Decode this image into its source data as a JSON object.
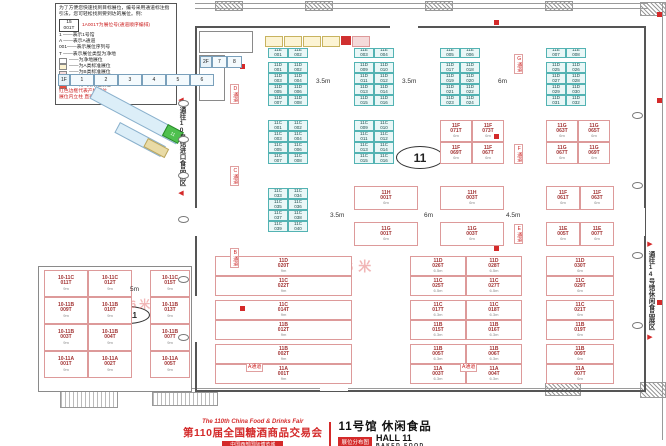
{
  "legend": {
    "intro": "为了方便您快速找到目标展位，编号采用通道标注指引法，您可轻松找到要到达的展位。例：",
    "example_no": "15",
    "example_code": "001T",
    "example_note": "1A001T为展位号(通道顺序编排)",
    "defs": [
      "1 ——表示1号馆",
      "A ——表示A通道",
      "001——表示展位序列号",
      "T ——表示展位类型为净地"
    ],
    "swatches": [
      {
        "color": "#ffffff",
        "label": "——为净地展位"
      },
      {
        "color": "#fdf3d1",
        "label": "——为A类标准展位"
      },
      {
        "color": "#f9dcdc",
        "label": "——为B类标准展位"
      },
      {
        "color": "#e0f3f3",
        "label": "——为C类标准展位"
      },
      {
        "color": "#e74c3c",
        "label": "——为D类标准展位"
      }
    ],
    "notes": [
      "红色边框代表产权展位",
      "展位内立柱 直径均为1.5m"
    ]
  },
  "minimap": {
    "floors": [
      {
        "label": "2F",
        "x": 200,
        "y": 56,
        "cw": 13,
        "cells": [
          "7",
          "8"
        ]
      },
      {
        "label": "1F",
        "x": 58,
        "y": 74,
        "cw": 22,
        "cells": [
          "1",
          "2",
          "3",
          "4",
          "5",
          "6"
        ]
      }
    ],
    "current": "11"
  },
  "corridors": {
    "left": "通往10号馆进口食品展区",
    "right": "通往14号馆休闲食品展区",
    "left_arrow": "◀",
    "right_arrow": "▶"
  },
  "ovals": {
    "hall": "11",
    "wing": "10-11"
  },
  "watermark": {
    "text": "净地展位限高6米"
  },
  "title": {
    "en": "The 110th China Food & Drinks Fair",
    "cn": "第110届全国糖酒商品交易会",
    "sub": "中国西部国际博览城",
    "hall_cn": "11号馆 休闲食品",
    "hall_en": "HALL 11",
    "hall_sub": "BAKED FOOD",
    "badge": "展位分布图"
  },
  "dim_labels": [
    {
      "t": "3.5m",
      "x": 316,
      "y": 78
    },
    {
      "t": "3.5m",
      "x": 402,
      "y": 78
    },
    {
      "t": "6m",
      "x": 498,
      "y": 78
    },
    {
      "t": "3.5m",
      "x": 330,
      "y": 212
    },
    {
      "t": "6m",
      "x": 424,
      "y": 212
    },
    {
      "t": "4.5m",
      "x": 506,
      "y": 212
    },
    {
      "t": "5m",
      "x": 130,
      "y": 286
    }
  ],
  "aisle_labels": [
    {
      "t": "D通道",
      "x": 230,
      "y": 84,
      "v": 1
    },
    {
      "t": "C通道",
      "x": 230,
      "y": 166,
      "v": 1
    },
    {
      "t": "B通道",
      "x": 230,
      "y": 248,
      "v": 1
    },
    {
      "t": "G通道",
      "x": 514,
      "y": 54,
      "v": 1
    },
    {
      "t": "F通道",
      "x": 514,
      "y": 144,
      "v": 1
    },
    {
      "t": "E通道",
      "x": 514,
      "y": 224,
      "v": 1
    },
    {
      "t": "A通道",
      "x": 246,
      "y": 363,
      "v": 0
    },
    {
      "t": "A通道",
      "x": 460,
      "y": 363,
      "v": 0
    }
  ],
  "fire_icons": [
    [
      494,
      20
    ],
    [
      494,
      134
    ],
    [
      494,
      246
    ],
    [
      657,
      12
    ],
    [
      657,
      98
    ],
    [
      657,
      300
    ],
    [
      240,
      64
    ],
    [
      240,
      306
    ]
  ],
  "column_markers": [
    [
      178,
      100
    ],
    [
      178,
      136
    ],
    [
      178,
      172
    ],
    [
      178,
      216
    ],
    [
      178,
      276
    ],
    [
      178,
      334
    ],
    [
      632,
      112
    ],
    [
      632,
      182
    ],
    [
      632,
      252
    ],
    [
      632,
      322
    ]
  ],
  "booths": [
    {
      "x": 268,
      "y": 48,
      "cols": 2,
      "cw": 20,
      "ch": 10,
      "type": "std",
      "labels": [
        "11E 001",
        "11E 002"
      ]
    },
    {
      "x": 354,
      "y": 48,
      "cols": 2,
      "cw": 20,
      "ch": 10,
      "type": "std",
      "labels": [
        "11E 003",
        "11E 004"
      ]
    },
    {
      "x": 440,
      "y": 48,
      "cols": 2,
      "cw": 20,
      "ch": 10,
      "type": "std",
      "labels": [
        "11E 005",
        "11E 006"
      ]
    },
    {
      "x": 546,
      "y": 48,
      "cols": 2,
      "cw": 20,
      "ch": 10,
      "type": "std",
      "labels": [
        "11E 007",
        "11E 008"
      ]
    },
    {
      "x": 268,
      "y": 62,
      "cols": 2,
      "cw": 20,
      "ch": 11,
      "type": "std",
      "labels": [
        "11D 001",
        "11D 002",
        "11D 003",
        "11D 004",
        "11D 005",
        "11D 006",
        "11D 007",
        "11D 008"
      ]
    },
    {
      "x": 354,
      "y": 62,
      "cols": 2,
      "cw": 20,
      "ch": 11,
      "type": "std",
      "labels": [
        "11D 009",
        "11D 010",
        "11D 011",
        "11D 012",
        "11D 013",
        "11D 014",
        "11D 015",
        "11D 016"
      ]
    },
    {
      "x": 440,
      "y": 62,
      "cols": 2,
      "cw": 20,
      "ch": 11,
      "type": "std",
      "labels": [
        "11D 017",
        "11D 018",
        "11D 019",
        "11D 020",
        "11D 021",
        "11D 022",
        "11D 023",
        "11D 024"
      ]
    },
    {
      "x": 546,
      "y": 62,
      "cols": 2,
      "cw": 20,
      "ch": 11,
      "type": "std",
      "labels": [
        "11D 025",
        "11D 026",
        "11D 027",
        "11D 028",
        "11D 029",
        "11D 030",
        "11D 031",
        "11D 032"
      ]
    },
    {
      "x": 268,
      "y": 120,
      "cols": 2,
      "cw": 20,
      "ch": 11,
      "type": "std",
      "labels": [
        "11C 001",
        "11C 002",
        "11C 003",
        "11C 004",
        "11C 005",
        "11C 006",
        "11C 007",
        "11C 008"
      ]
    },
    {
      "x": 354,
      "y": 120,
      "cols": 2,
      "cw": 20,
      "ch": 11,
      "type": "std",
      "labels": [
        "11C 009",
        "11C 010",
        "11C 011",
        "11C 012",
        "11C 013",
        "11C 014",
        "11C 015",
        "11C 016"
      ]
    },
    {
      "x": 440,
      "y": 120,
      "cols": 2,
      "cw": 32,
      "ch": 22,
      "type": "special",
      "dim": "6m",
      "labels": [
        "11F 071T",
        "11F 073T",
        "11F 069T",
        "11F 067T"
      ]
    },
    {
      "x": 546,
      "y": 120,
      "cols": 2,
      "cw": 32,
      "ch": 22,
      "type": "special",
      "dim": "6m",
      "labels": [
        "11G 063T",
        "11G 065T",
        "11G 067T",
        "11G 069T"
      ]
    },
    {
      "x": 268,
      "y": 188,
      "cols": 2,
      "cw": 20,
      "ch": 11,
      "type": "std",
      "labels": [
        "11C 033",
        "11C 034",
        "11C 035",
        "11C 036",
        "11C 037",
        "11C 038",
        "11C 039",
        "11C 040"
      ]
    },
    {
      "x": 354,
      "y": 186,
      "cols": 1,
      "cw": 64,
      "ch": 24,
      "type": "special",
      "dim": "6m",
      "labels": [
        "11H 001T"
      ]
    },
    {
      "x": 440,
      "y": 186,
      "cols": 1,
      "cw": 64,
      "ch": 24,
      "type": "special",
      "dim": "6m",
      "labels": [
        "11H 003T"
      ]
    },
    {
      "x": 546,
      "y": 186,
      "cols": 2,
      "cw": 34,
      "ch": 24,
      "type": "special",
      "dim": "6m",
      "labels": [
        "11F 061T",
        "11F 063T"
      ]
    },
    {
      "x": 354,
      "y": 222,
      "cols": 1,
      "cw": 64,
      "ch": 24,
      "type": "special",
      "dim": "6m",
      "labels": [
        "11G 001T"
      ]
    },
    {
      "x": 440,
      "y": 222,
      "cols": 1,
      "cw": 64,
      "ch": 24,
      "type": "special",
      "dim": "6m",
      "labels": [
        "11G 003T"
      ]
    },
    {
      "x": 546,
      "y": 222,
      "cols": 2,
      "cw": 34,
      "ch": 24,
      "type": "special",
      "dim": "6m",
      "labels": [
        "11E 005T",
        "11E 007T"
      ]
    },
    {
      "x": 215,
      "y": 256,
      "cols": 1,
      "cw": 137,
      "ch": 20,
      "type": "special",
      "dim": "9m",
      "labels": [
        "11D 020T",
        "11C 022T"
      ]
    },
    {
      "x": 215,
      "y": 300,
      "cols": 1,
      "cw": 137,
      "ch": 20,
      "type": "special",
      "dim": "9m",
      "labels": [
        "11C 014T",
        "11B 012T"
      ]
    },
    {
      "x": 215,
      "y": 344,
      "cols": 1,
      "cw": 137,
      "ch": 20,
      "type": "special",
      "dim": "9m",
      "labels": [
        "11B 002T",
        "11A 001T"
      ]
    },
    {
      "x": 410,
      "y": 256,
      "cols": 2,
      "cw": 56,
      "ch": 20,
      "type": "special",
      "dim": "6.5m",
      "labels": [
        "11D 026T",
        "11D 028T",
        "11C 025T",
        "11C 027T"
      ]
    },
    {
      "x": 410,
      "y": 300,
      "cols": 2,
      "cw": 56,
      "ch": 20,
      "type": "special",
      "dim": "6.3m",
      "labels": [
        "11C 017T",
        "11C 018T",
        "11B 015T",
        "11B 016T"
      ]
    },
    {
      "x": 410,
      "y": 344,
      "cols": 2,
      "cw": 56,
      "ch": 20,
      "type": "special",
      "dim": "6.3m",
      "labels": [
        "11B 005T",
        "11B 006T",
        "11A 003T",
        "11A 004T"
      ]
    },
    {
      "x": 546,
      "y": 256,
      "cols": 1,
      "cw": 68,
      "ch": 20,
      "type": "special",
      "dim": "6m",
      "labels": [
        "11D 030T",
        "11C 029T"
      ]
    },
    {
      "x": 546,
      "y": 300,
      "cols": 1,
      "cw": 68,
      "ch": 20,
      "type": "special",
      "dim": "6m",
      "labels": [
        "11C 021T",
        "11B 019T"
      ]
    },
    {
      "x": 546,
      "y": 344,
      "cols": 1,
      "cw": 68,
      "ch": 20,
      "type": "special",
      "dim": "6m",
      "labels": [
        "11B 009T",
        "11A 007T"
      ]
    },
    {
      "x": 44,
      "y": 270,
      "cols": 2,
      "cw": 44,
      "ch": 27,
      "type": "special",
      "dim": "9m",
      "labels": [
        "10-11C 011T",
        "10-11C 012T",
        "10-11B 009T",
        "10-11B 010T",
        "10-11B 003T",
        "10-11B 004T",
        "10-11A 001T",
        "10-11A 002T"
      ]
    },
    {
      "x": 150,
      "y": 270,
      "cols": 1,
      "cw": 40,
      "ch": 27,
      "type": "special",
      "dim": "9m",
      "labels": [
        "10-11C 015T",
        "10-11B 013T",
        "10-11B 007T",
        "10-11A 005T"
      ]
    }
  ]
}
